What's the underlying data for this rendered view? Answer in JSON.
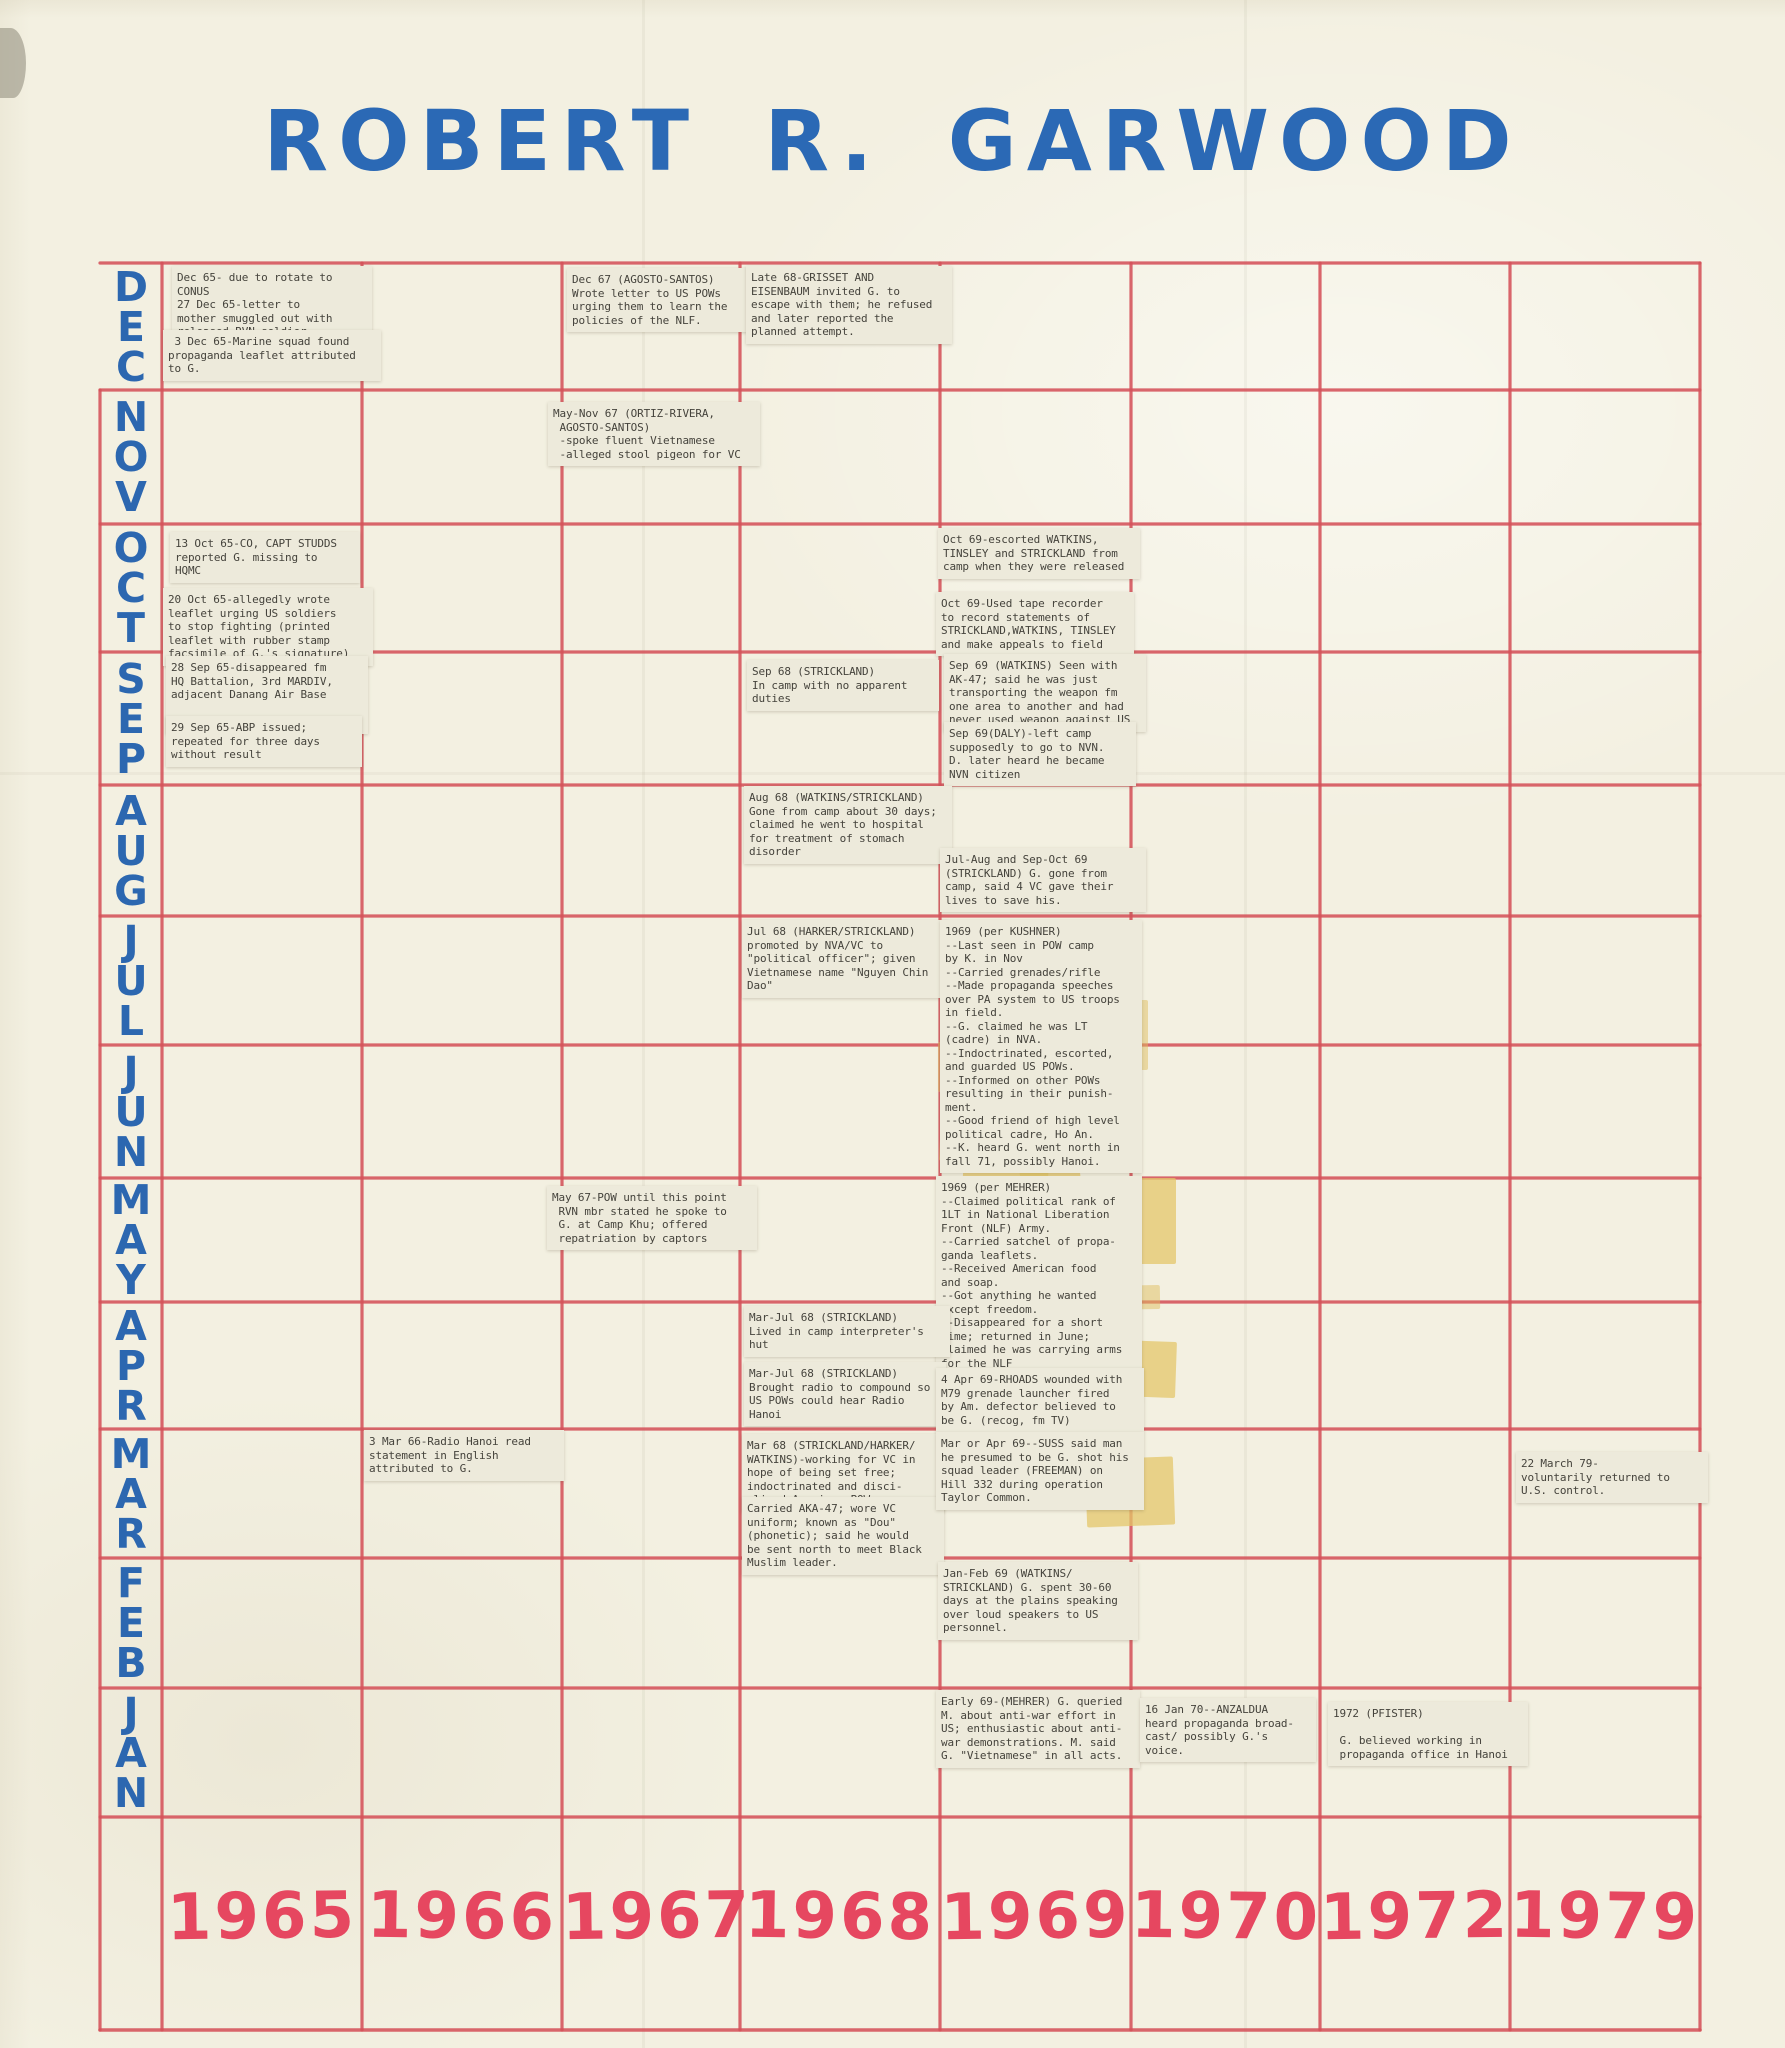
{
  "title": "ROBERT R. GARWOOD",
  "colors": {
    "paper": "#f3f0e1",
    "grid_line": "#d5525a",
    "month_label": "#2c67b0",
    "year_label": "#e64760",
    "note_background": "#edeadb",
    "note_text": "#45433c",
    "tape": "#e0be5f",
    "title_blue": "#2b69b5"
  },
  "chart_data": {
    "type": "table",
    "title": "ROBERT R. GARWOOD",
    "description": "Hand-drawn timeline matrix: months (Dec top to Jan bottom) vs years; typewritten event slips taped into cells",
    "rows_months": [
      "DEC",
      "NOV",
      "OCT",
      "SEP",
      "AUG",
      "JUL",
      "JUN",
      "MAY",
      "APR",
      "MAR",
      "FEB",
      "JAN"
    ],
    "columns_years": [
      "1965",
      "1966",
      "1967",
      "1968",
      "1969",
      "1970",
      "1972",
      "1979"
    ],
    "grid": true,
    "events": [
      {
        "id": "dec65-rotate",
        "year": "1965",
        "month_row": "DEC",
        "box": [
          172,
          266,
          190
        ],
        "text": "Dec 65- due to rotate to\nCONUS\n27 Dec 65-letter to\nmother smuggled out with\nreleased RVN soldier"
      },
      {
        "id": "dec65-leaflet",
        "year": "1965",
        "month_row": "DEC",
        "box": [
          163,
          330,
          208
        ],
        "text": " 3 Dec 65-Marine squad found\npropaganda leaflet attributed\nto G."
      },
      {
        "id": "dec67-letter",
        "year": "1967",
        "month_row": "DEC",
        "box": [
          567,
          268,
          184
        ],
        "text": "Dec 67 (AGOSTO-SANTOS)\nWrote letter to US POWs\nurging them to learn the\npolicies of the NLF."
      },
      {
        "id": "late68-escape",
        "year": "1968",
        "month_row": "DEC",
        "box": [
          746,
          266,
          196
        ],
        "text": "Late 68-GRISSET AND\nEISENBAUM invited G. to\nescape with them; he refused\nand later reported the\nplanned attempt."
      },
      {
        "id": "maynov67-vietnamese",
        "year": "1967",
        "month_row": "NOV",
        "box": [
          548,
          402,
          202
        ],
        "text": "May-Nov 67 (ORTIZ-RIVERA,\n AGOSTO-SANTOS)\n -spoke fluent Vietnamese\n -alleged stool pigeon for VC"
      },
      {
        "id": "oct65-missing",
        "year": "1965",
        "month_row": "OCT",
        "box": [
          170,
          532,
          180
        ],
        "text": "13 Oct 65-CO, CAPT STUDDS\nreported G. missing to\nHQMC"
      },
      {
        "id": "oct65-leaflet",
        "year": "1965",
        "month_row": "OCT",
        "box": [
          163,
          588,
          200
        ],
        "text": "20 Oct 65-allegedly wrote\nleaflet urging US soldiers\nto stop fighting (printed\nleaflet with rubber stamp\nfacsimile of G.'s signature)"
      },
      {
        "id": "oct69-escorted",
        "year": "1969",
        "month_row": "OCT",
        "box": [
          938,
          528,
          192
        ],
        "text": "Oct 69-escorted WATKINS,\nTINSLEY and STRICKLAND from\ncamp when they were released"
      },
      {
        "id": "oct69-tape-recorder",
        "year": "1969",
        "month_row": "OCT",
        "box": [
          936,
          592,
          188
        ],
        "text": "Oct 69-Used tape recorder\nto record statements of\nSTRICKLAND,WATKINS, TINSLEY\nand make appeals to field"
      },
      {
        "id": "sep65-disappeared",
        "year": "1965",
        "month_row": "SEP",
        "box": [
          166,
          656,
          192
        ],
        "text": "28 Sep 65-disappeared fm\nHQ Battalion, 3rd MARDIV,\nadjacent Danang Air Base\n\nlast seen by Pfc GEILL"
      },
      {
        "id": "sep65-abp",
        "year": "1965",
        "month_row": "SEP",
        "box": [
          166,
          716,
          186
        ],
        "text": "29 Sep 65-ABP issued;\nrepeated for three days\nwithout result"
      },
      {
        "id": "sep68-no-duties",
        "year": "1968",
        "month_row": "SEP",
        "box": [
          747,
          660,
          182
        ],
        "text": "Sep 68 (STRICKLAND)\nIn camp with no apparent\nduties"
      },
      {
        "id": "sep69-ak47",
        "year": "1969",
        "month_row": "SEP",
        "box": [
          944,
          654,
          192
        ],
        "text": "Sep 69 (WATKINS) Seen with\nAK-47; said he was just\ntransporting the weapon fm\none area to another and had\nnever used weapon against US"
      },
      {
        "id": "sep69-daly",
        "year": "1969",
        "month_row": "SEP",
        "box": [
          944,
          722,
          182
        ],
        "text": "Sep 69(DALY)-left camp\nsupposedly to go to NVN.\nD. later heard he became\nNVN citizen"
      },
      {
        "id": "aug68-hospital",
        "year": "1968",
        "month_row": "AUG",
        "box": [
          744,
          786,
          198
        ],
        "text": "Aug 68 (WATKINS/STRICKLAND)\nGone from camp about 30 days;\nclaimed he went to hospital\nfor treatment of stomach\ndisorder"
      },
      {
        "id": "julaug69-gone",
        "year": "1969",
        "month_row": "AUG",
        "box": [
          940,
          848,
          196
        ],
        "text": "Jul-Aug and Sep-Oct 69\n(STRICKLAND) G. gone from\ncamp, said 4 VC gave their\nlives to save his."
      },
      {
        "id": "jul68-political-officer",
        "year": "1968",
        "month_row": "JUL",
        "box": [
          742,
          920,
          196
        ],
        "text": "Jul 68 (HARKER/STRICKLAND)\npromoted by NVA/VC to\n\"political officer\"; given\nVietnamese name \"Nguyen Chin\nDao\""
      },
      {
        "id": "kushner-1969",
        "year": "1969",
        "month_row": "JUL-JUN",
        "box": [
          940,
          920,
          192
        ],
        "text": "1969 (per KUSHNER)\n--Last seen in POW camp\nby K. in Nov\n--Carried grenades/rifle\n--Made propaganda speeches\nover PA system to US troops\nin field.\n--G. claimed he was LT\n(cadre) in NVA.\n--Indoctrinated, escorted,\nand guarded US POWs.\n--Informed on other POWs\nresulting in their punish-\nment.\n--Good friend of high level\npolitical cadre, Ho An.\n--K. heard G. went north in\nfall 71, possibly Hanoi."
      },
      {
        "id": "may67-camp-khu",
        "year": "1967",
        "month_row": "MAY",
        "box": [
          547,
          1186,
          200
        ],
        "text": "May 67-POW until this point\n RVN mbr stated he spoke to\n G. at Camp Khu; offered\n repatriation by captors"
      },
      {
        "id": "mehrer-1969",
        "year": "1969",
        "month_row": "MAY-APR",
        "box": [
          936,
          1176,
          196
        ],
        "text": "1969 (per MEHRER)\n--Claimed political rank of\n1LT in National Liberation\nFront (NLF) Army.\n--Carried satchel of propa-\nganda leaflets.\n--Received American food\nand soap.\n--Got anything he wanted\nexcept freedom.\n--Disappeared for a short\ntime; returned in June;\nclaimed he was carrying arms\nfor the NLF\n--M. later heard G. was a\ncelebrity in NVN."
      },
      {
        "id": "marjul68-hut",
        "year": "1968",
        "month_row": "APR",
        "box": [
          744,
          1306,
          196
        ],
        "text": "Mar-Jul 68 (STRICKLAND)\nLived in camp interpreter's\nhut"
      },
      {
        "id": "marjul68-radio",
        "year": "1968",
        "month_row": "APR",
        "box": [
          744,
          1362,
          192
        ],
        "text": "Mar-Jul 68 (STRICKLAND)\nBrought radio to compound so\nUS POWs could hear Radio\nHanoi"
      },
      {
        "id": "apr69-rhoads",
        "year": "1969",
        "month_row": "APR",
        "box": [
          936,
          1368,
          198
        ],
        "text": "4 Apr 69-RHOADS wounded with\nM79 grenade launcher fired\nby Am. defector believed to\nbe G. (recog, fm TV)"
      },
      {
        "id": "mar66-radio-hanoi",
        "year": "1966",
        "month_row": "MAR",
        "box": [
          364,
          1430,
          190
        ],
        "text": "3 Mar 66-Radio Hanoi read\nstatement in English\nattributed to G."
      },
      {
        "id": "mar68-working",
        "year": "1968",
        "month_row": "MAR",
        "box": [
          742,
          1434,
          192
        ],
        "text": "Mar 68 (STRICKLAND/HARKER/\nWATKINS)-working for VC in\nhope of being set free;\nindoctrinated and disci-\nplined American POWs."
      },
      {
        "id": "mar68-aka47",
        "year": "1968",
        "month_row": "MAR",
        "box": [
          742,
          1497,
          192
        ],
        "text": "Carried AKA-47; wore VC\nuniform; known as \"Dou\"\n(phonetic); said he would\nbe sent north to meet Black\nMuslim leader."
      },
      {
        "id": "marapr69-suss",
        "year": "1969",
        "month_row": "MAR",
        "box": [
          936,
          1432,
          198
        ],
        "text": "Mar or Apr 69--SUSS said man\nhe presumed to be G. shot his\nsquad leader (FREEMAN) on\nHill 332 during operation\nTaylor Common."
      },
      {
        "id": "mar79-returned",
        "year": "1979",
        "month_row": "MAR",
        "box": [
          1516,
          1452,
          182
        ],
        "text": "22 March 79-\nvoluntarily returned to\nU.S. control."
      },
      {
        "id": "janfeb69-plains",
        "year": "1969",
        "month_row": "FEB",
        "box": [
          938,
          1562,
          190
        ],
        "text": "Jan-Feb 69 (WATKINS/\nSTRICKLAND) G. spent 30-60\ndays at the plains speaking\nover loud speakers to US\npersonnel."
      },
      {
        "id": "early69-antiwar",
        "year": "1969",
        "month_row": "JAN",
        "box": [
          936,
          1690,
          194
        ],
        "text": "Early 69-(MEHRER) G. queried\nM. about anti-war effort in\nUS; enthusiastic about anti-\nwar demonstrations. M. said\nG. \"Vietnamese\" in all acts."
      },
      {
        "id": "jan70-anzaldua",
        "year": "1970",
        "month_row": "JAN",
        "box": [
          1140,
          1698,
          166
        ],
        "text": "16 Jan 70--ANZALDUA\nheard propaganda broad-\ncast/ possibly G.'s\nvoice."
      },
      {
        "id": "pfister-1972",
        "year": "1972",
        "month_row": "JAN",
        "box": [
          1328,
          1702,
          190
        ],
        "text": "1972 (PFISTER)\n\n G. believed working in\n propaganda office in Hanoi"
      }
    ]
  }
}
